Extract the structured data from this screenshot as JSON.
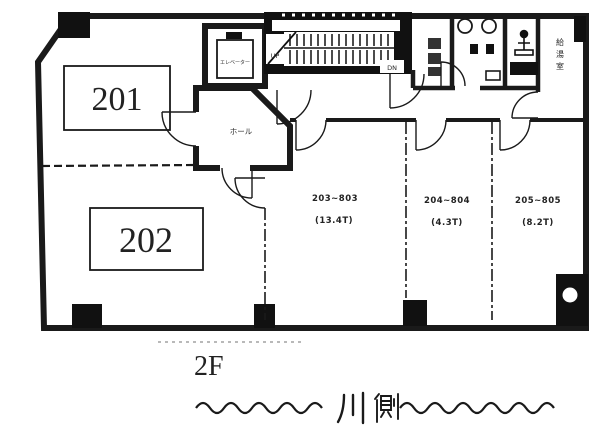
{
  "plan": {
    "room201_label": "201",
    "room202_label": "202",
    "room203_range": "203~803",
    "room203_area": "(13.4T)",
    "room204_range": "204~804",
    "room204_area": "(4.3T)",
    "room205_range": "205~805",
    "room205_area": "(8.2T)",
    "hall_label": "ホール",
    "elevator_label": "エレベーター",
    "stairs_up_label": "UP",
    "stairs_down_label": "DN",
    "utility_room_label": "給湯室"
  },
  "caption": {
    "floor_label": "2F",
    "orientation_text": "〜〜〜〜川側〜〜〜〜〜〜〜〜"
  },
  "colors": {
    "ink": "#1a1a1a",
    "paper": "#ffffff"
  }
}
